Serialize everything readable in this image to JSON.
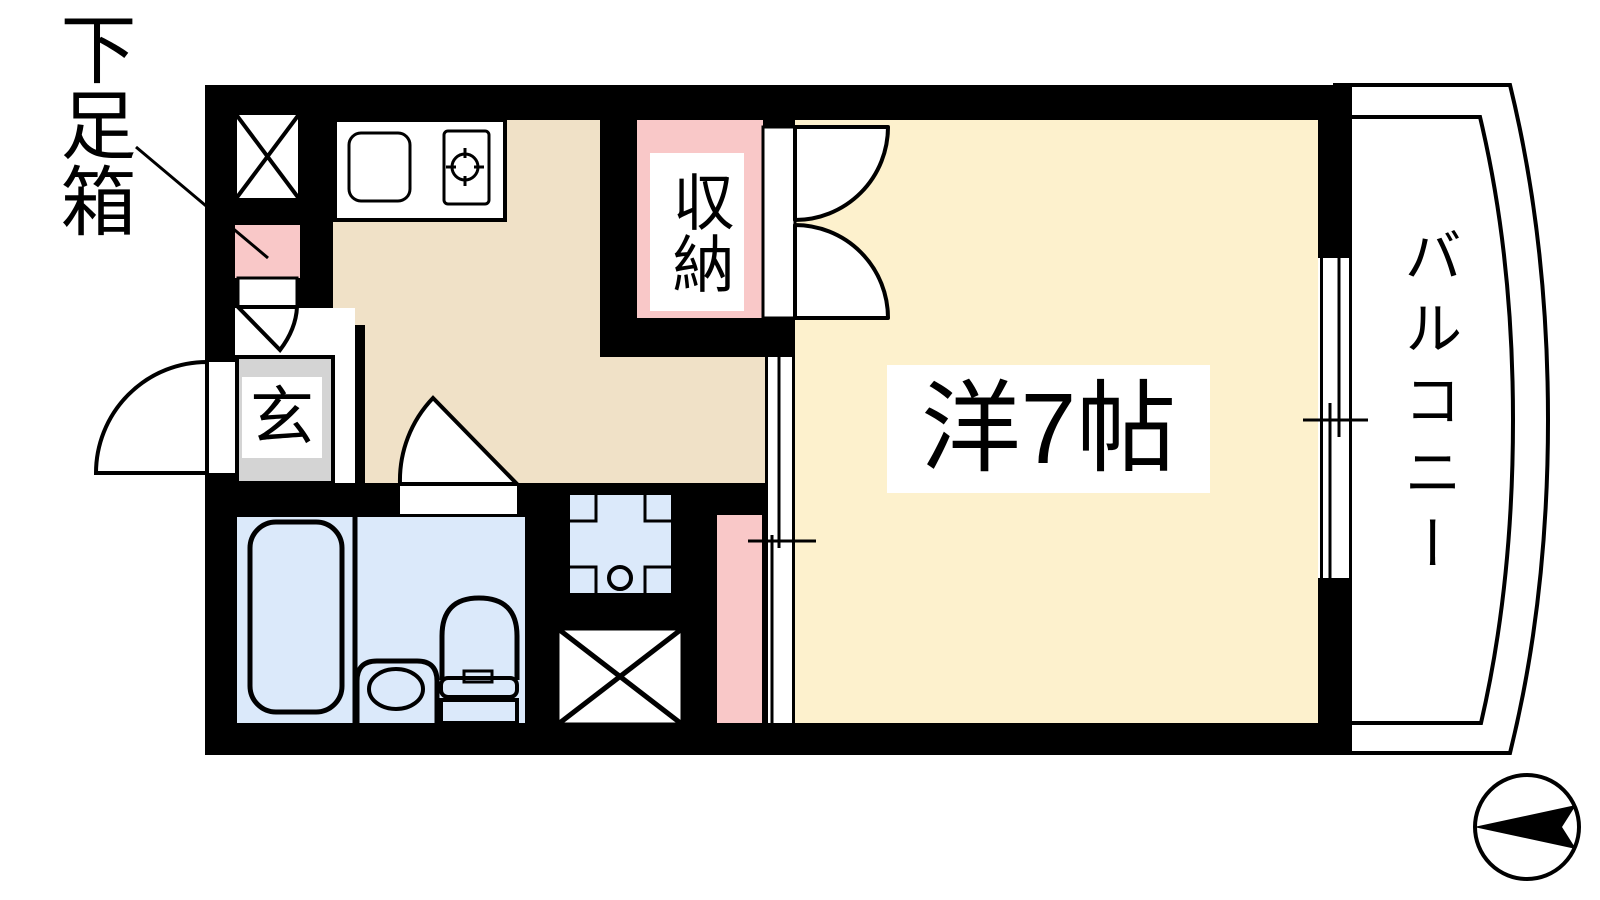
{
  "floorplan": {
    "labels": {
      "shoe_box": "下足箱",
      "entrance": "玄",
      "closet": "収納",
      "room": "洋7帖",
      "balcony": "バルコニー"
    },
    "colors": {
      "wall": "#000000",
      "kitchen_floor": "#f0e1c7",
      "room_floor": "#fdf1cd",
      "bath_floor": "#dbe9fa",
      "accent_pink": "#f9c8c8",
      "mat_gray": "#d4d4d4",
      "paper": "#ffffff",
      "line": "#000000"
    },
    "icons": {
      "north_arrow": "arrow-pointing-left-in-circle",
      "pipe_space": "box-with-x-cross",
      "burner": "gas-burner-circle",
      "door_swings": "quarter-circle-arcs",
      "windows": "parallel-line-sliding-sash"
    }
  }
}
